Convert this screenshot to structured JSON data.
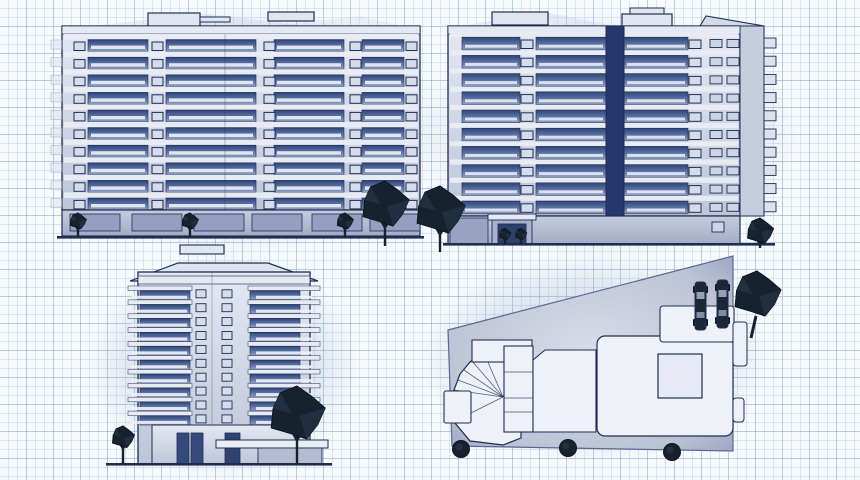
{
  "image": {
    "type": "architectural-blueprint-render",
    "description": "Four blueprint-style views of a ten-storey apartment block drawn on graph paper",
    "text_content": []
  },
  "colors": {
    "paper": "#f7fafc",
    "grid_minor": "rgba(150,180,212,0.28)",
    "grid_major": "rgba(118,152,190,0.34)",
    "ink": "#1f2d52",
    "wall_light": "#e2e6f1",
    "wall_mid": "#c6cddf",
    "window_band_dark": "#2e4376",
    "window_band_light": "#91a1c4",
    "slab_white": "#eef1f7",
    "small_window": "#d6dcec",
    "stripe": "#24386e",
    "ground_strip": "#a9b2cc",
    "plate_edge": "#97a1bf",
    "roof_white": "#eff1f8",
    "tree_dark": "#17222f",
    "tree_facet": "#2a3c52",
    "car_body": "#1b2637"
  },
  "grid": {
    "minor_px": 9,
    "major_px": 27
  },
  "views": {
    "front_elevation": {
      "label": "front elevation",
      "floors": 10,
      "rooftop_structures": 2,
      "street_trees": 3,
      "large_trees": 1,
      "window_column_count": 5
    },
    "rear_elevation": {
      "label": "rear elevation",
      "floors": 10,
      "balcony_tabs": 10,
      "entrance_doors": 1,
      "large_trees": 2,
      "bushes": 2
    },
    "end_elevation": {
      "label": "end elevation",
      "floors": 10,
      "rooftop_structures": 1,
      "doors": 3,
      "trees": 2
    },
    "roof_plan": {
      "label": "roof plan",
      "cars": 2,
      "perimeter_trees": 3,
      "large_trees": 1,
      "roof_blocks": 8
    }
  }
}
